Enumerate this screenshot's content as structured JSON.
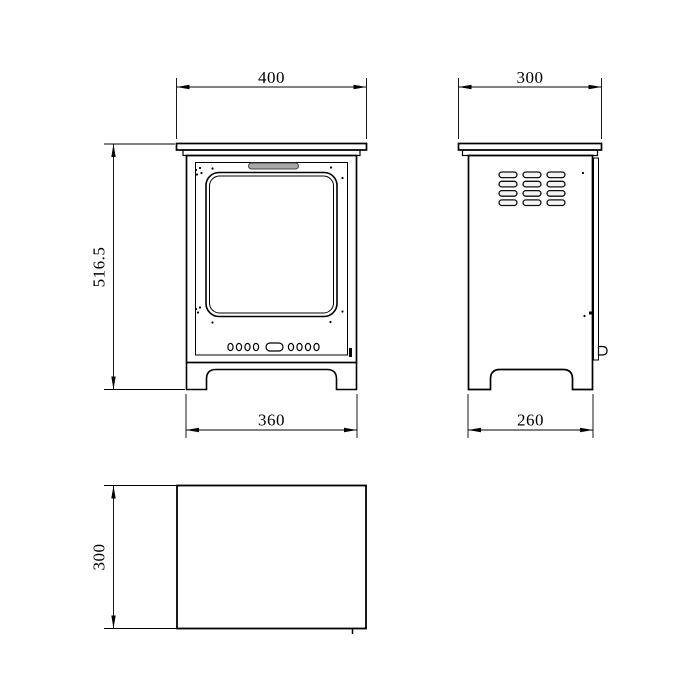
{
  "page": {
    "background_color": "#ffffff",
    "line_color": "#000000",
    "handle_fill": "#a8a8a8",
    "drawing_type": "technical dimension drawing of a freestanding stove / electric fireplace"
  },
  "views": {
    "front": {
      "name": "front view",
      "dim_top_width": "400",
      "dim_height": "516.5",
      "dim_base_width": "360"
    },
    "side": {
      "name": "side view",
      "dim_top_depth": "300",
      "dim_base_depth": "260"
    },
    "top": {
      "name": "top view",
      "dim_depth": "300"
    }
  }
}
